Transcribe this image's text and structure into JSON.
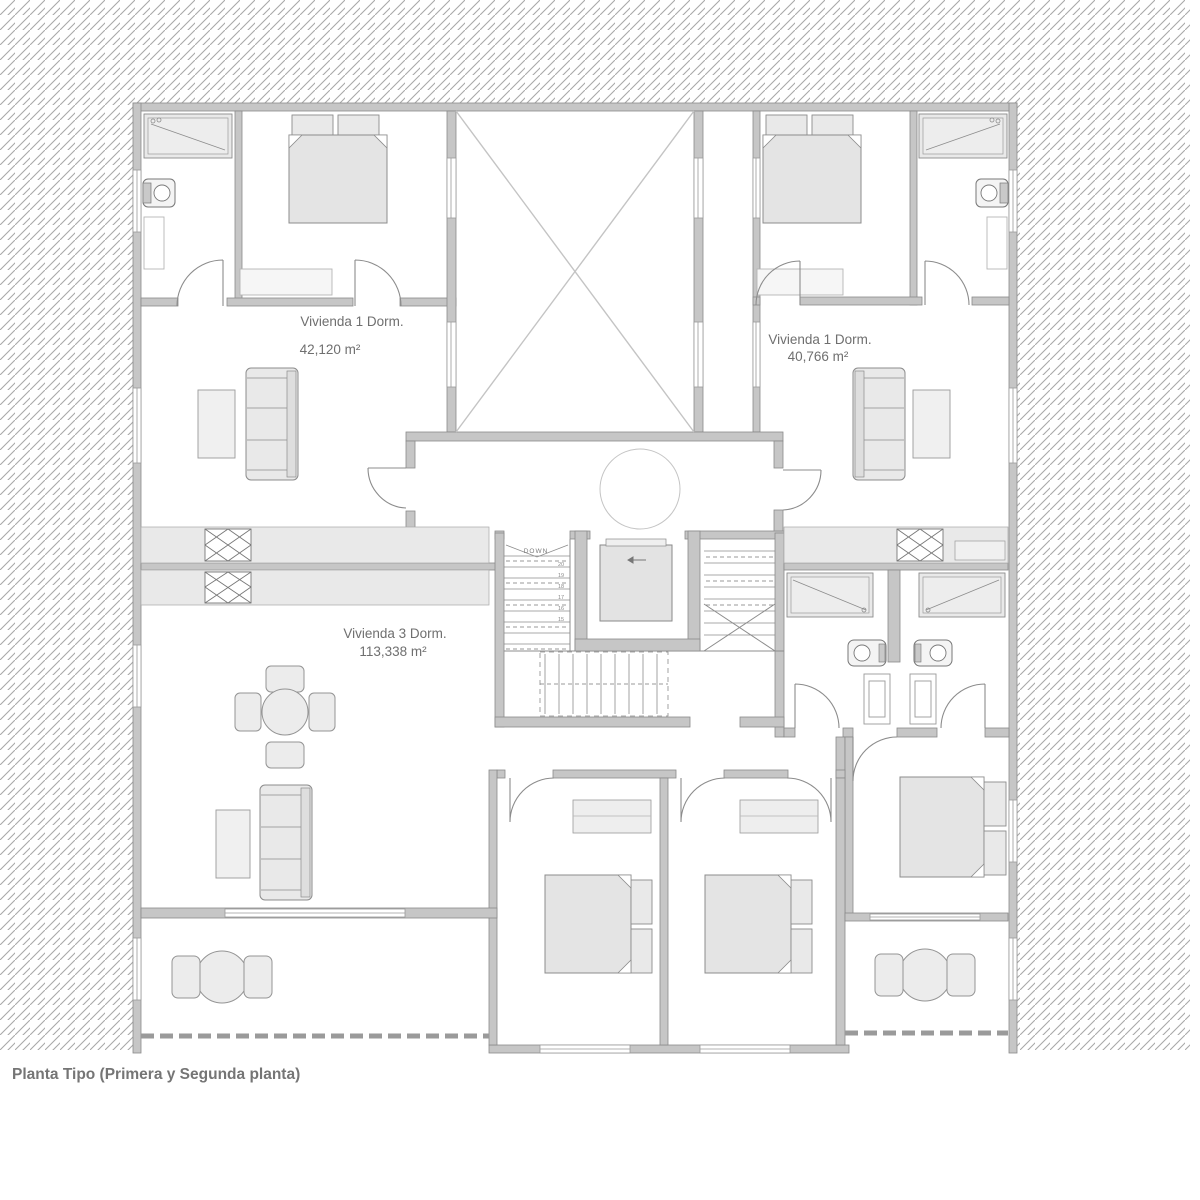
{
  "plan": {
    "caption": "Planta Tipo (Primera y Segunda planta)",
    "apartments": [
      {
        "name": "Vivienda  1 Dorm.",
        "area": "42,120 m²"
      },
      {
        "name": "Vivienda 1 Dorm.",
        "area": "40,766 m²"
      },
      {
        "name": "Vivienda 3 Dorm.",
        "area": "113,338 m²"
      }
    ],
    "stair": {
      "down_label": "DOWN",
      "treads": [
        "20",
        "19",
        "18",
        "17",
        "16",
        "15"
      ]
    },
    "colors": {
      "wall_fill": "#c6c6c6",
      "wall_stroke": "#8a8a8a",
      "furniture_fill": "#e9e9e9",
      "bed_fill": "#e4e4e4",
      "hatch_line": "#a9a9a9",
      "text": "#6f6f6f"
    }
  }
}
